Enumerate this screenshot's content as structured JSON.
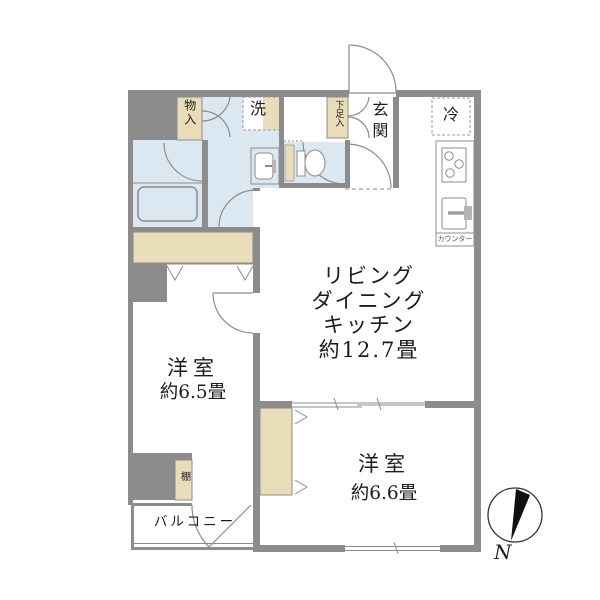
{
  "floorplan": {
    "rooms": {
      "ldk": {
        "lines": [
          "リビング",
          "ダイニング",
          "キッチン",
          "約12.7畳"
        ]
      },
      "bedroom_west": {
        "name": "洋室",
        "size": "約6.5畳"
      },
      "bedroom_south": {
        "name": "洋室",
        "size": "約6.6畳"
      },
      "entrance": {
        "name": "玄関"
      },
      "balcony": {
        "name": "バルコニー"
      }
    },
    "labels": {
      "storage": "物入",
      "washer": "洗",
      "shoe_cabinet": "下足入",
      "refrigerator": "冷",
      "kitchen_counter": "カウンター",
      "shelf": "棚"
    },
    "compass": {
      "north": "N"
    },
    "colors": {
      "wall": "#8c8c8c",
      "wet_area_floor": "#dce8f1",
      "closet_fill": "#e9ddb9",
      "outline": "#8c8c8c",
      "text": "#1c1c1c"
    }
  }
}
